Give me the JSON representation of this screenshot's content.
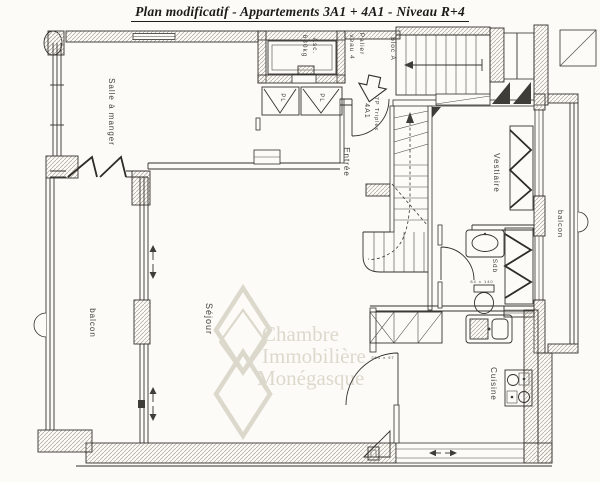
{
  "title": "Plan modificatif - Appartements 3A1 + 4A1 - Niveau R+4",
  "watermark": {
    "line1": "Chambre",
    "line2": "Immobilière",
    "line3": "Monégasque"
  },
  "rooms": {
    "salle_a_manger": "Salle à manger",
    "sejour": "Séjour",
    "balcon_left": "balcon",
    "balcon_right": "balcon",
    "entree": "Entrée",
    "vestiaire": "Vestiaire",
    "sdb": "Sdb",
    "cuisine": "Cuisine"
  },
  "annotations": {
    "elevator_name": "Asc.",
    "elevator_capacity": "630kg",
    "palier": "Palier",
    "palier_level": "veau 4",
    "block": "bloc A",
    "unit_line1": "7P Triplex",
    "unit_line2": "4A1",
    "closet_left": "PL",
    "closet_right": "PL",
    "bath_dim": "84 x 140",
    "kitchen_dim": "264 x 97"
  },
  "colors": {
    "paper": "#fcfbf8",
    "ink": "#33312c",
    "watermark": "#dcd9cc"
  }
}
